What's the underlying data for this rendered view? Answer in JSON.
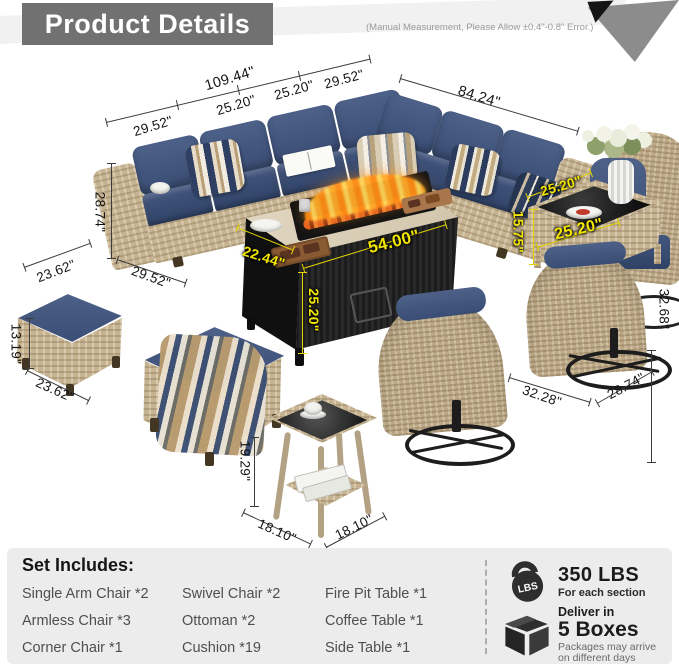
{
  "header": {
    "title": "Product Details",
    "note": "(Manual Measurement, Please Allow ±0.4\"-0.8\" Error.)"
  },
  "dims": {
    "d1": "109.44\"",
    "d2": "29.52\"",
    "d3": "25.20\"",
    "d4": "25.20\"",
    "d5": "29.52\"",
    "d6": "84.24\"",
    "d7": "28.74\"",
    "d8": "23.62\"",
    "d9": "29.52\"",
    "d10": "13.19\"",
    "d11": "23.62\"",
    "d12": "19.29\"",
    "d13": "18.10\"",
    "d14": "18.10\"",
    "d15": "32.28\"",
    "d16": "28.74\"",
    "d17": "32.68\"",
    "y1": "22.44\"",
    "y2": "54.00\"",
    "y3": "25.20\"",
    "y4": "25.20\"",
    "y5": "25.20\"",
    "y6": "15.75\""
  },
  "set_includes": {
    "title": "Set Includes:",
    "columns": [
      {
        "items": [
          "Single Arm Chair *2",
          "Armless Chair *3",
          "Corner Chair *1"
        ]
      },
      {
        "items": [
          "Swivel Chair *2",
          "Ottoman *2",
          "Cushion *19"
        ]
      },
      {
        "items": [
          "Fire Pit Table *1",
          "Coffee Table *1",
          "Side Table *1"
        ]
      }
    ]
  },
  "badges": {
    "weight": {
      "icon_label": "LBS",
      "value": "350 LBS",
      "caption": "For each section"
    },
    "delivery": {
      "lead": "Deliver in",
      "value": "5 Boxes",
      "caption_line1": "Packages may arrive",
      "caption_line2": "on different days"
    }
  },
  "colors": {
    "accent_yellow": "#f3e603",
    "cushion_navy": "#42557c",
    "wicker_tan": "#c6b392",
    "panel_gray": "#ececec",
    "header_gray": "#717171",
    "flame_orange": "#ff9a2a"
  }
}
